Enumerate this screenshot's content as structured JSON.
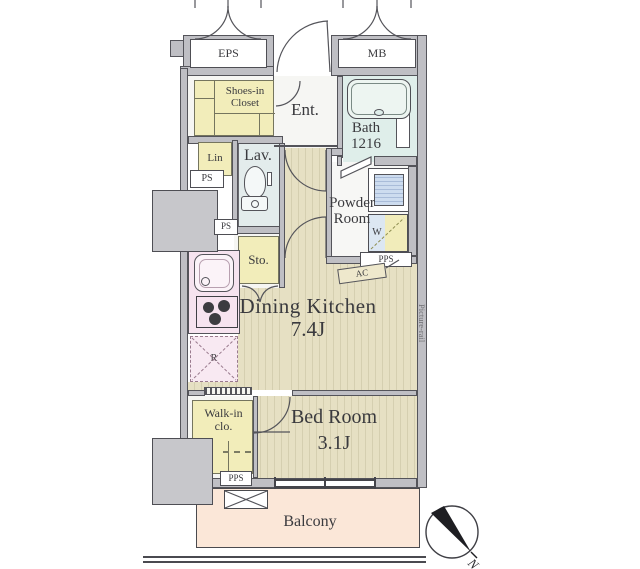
{
  "shafts": {
    "eps": "EPS",
    "mb": "MB"
  },
  "rooms": {
    "shoes_closet": {
      "line1": "Shoes-in",
      "line2": "Closet"
    },
    "entrance": {
      "label": "Ent."
    },
    "bath": {
      "line1": "Bath",
      "line2": "1216"
    },
    "linen": {
      "label": "Lin"
    },
    "ps_upper": {
      "label": "PS"
    },
    "lavatory": {
      "label": "Lav."
    },
    "ps_mid": {
      "label": "PS"
    },
    "storage": {
      "label": "Sto."
    },
    "powder_room": {
      "line1": "Powder",
      "line2": "Room"
    },
    "washer": {
      "label": "W"
    },
    "pps_right": {
      "label": "PPS"
    },
    "ac": {
      "label": "AC"
    },
    "dining_kitchen": {
      "name": "Dining Kitchen",
      "size": "7.4J"
    },
    "refrigerator": {
      "label": "R"
    },
    "picture_rail": {
      "label": "Picture-rail"
    },
    "walk_in_closet": {
      "line1": "Walk-in",
      "line2": "clo."
    },
    "bed_room": {
      "name": "Bed Room",
      "size": "3.1J"
    },
    "pps_bottom": {
      "label": "PPS"
    },
    "balcony": {
      "label": "Balcony"
    }
  },
  "compass": {
    "label": "N"
  },
  "colors": {
    "wall": "#bfbfc4",
    "wall_line": "#54545a",
    "closet_yellow": "#f2edba",
    "floor": "#e6e0c3",
    "floor_stripe": "#d5cfb0",
    "bath_blue": "#dfeeea",
    "lavatory_blue": "#e3ecec",
    "kitchen_pink": "#f6e3ef",
    "fridge_pink": "#f8e9f2",
    "balcony_peach": "#fbe7d8",
    "vanity_blue": "#cddcef",
    "washer_blue": "#dce7f2"
  }
}
